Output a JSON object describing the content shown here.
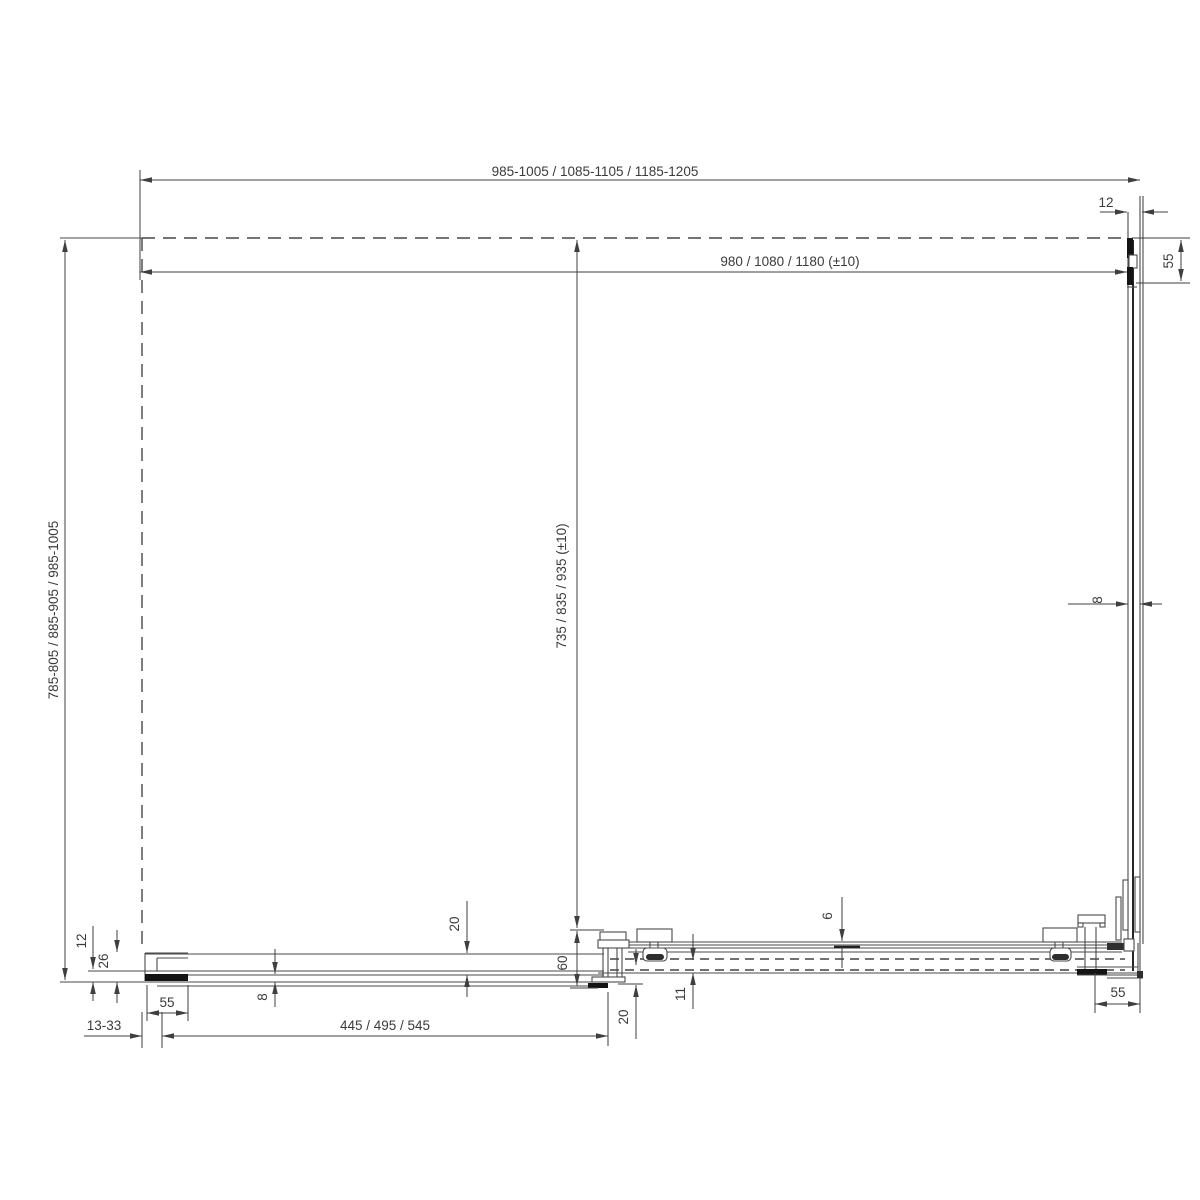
{
  "drawing": {
    "type": "shower-enclosure-installation-top-view",
    "dimensions": {
      "width_overall": "985-1005 / 1085-1105 / 1185-1205",
      "width_glass": "980 / 1080 / 1180 (±10)",
      "profile_width_top_right": "12",
      "profile_depth_right": "55",
      "depth_overall": "785-805 / 885-905 / 985-1005",
      "depth_glass": "735 / 835 / 935 (±10)",
      "glass_thickness_right": "8",
      "wall_gap_12": "12",
      "wall_gap_26": "26",
      "profile_width_left": "55",
      "adjustment_range": "13-33",
      "glass_thickness_left": "8",
      "fixed_panel_width": "445 / 495 / 545",
      "rail_offset_20": "20",
      "overlap_60": "60",
      "door_gap_20": "20",
      "gap_6": "6",
      "rail_height_11": "11",
      "profile_width_bottom_right": "55"
    }
  }
}
